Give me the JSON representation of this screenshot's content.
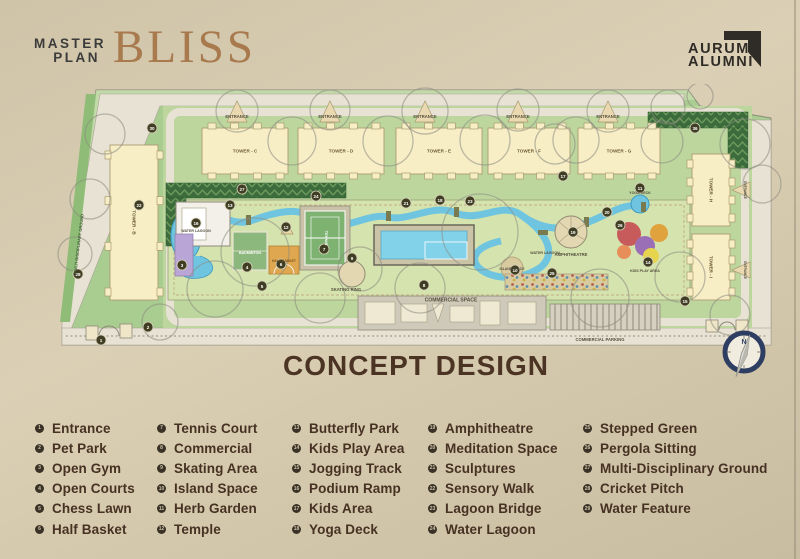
{
  "header": {
    "master": "MASTER",
    "plan": "PLAN",
    "brand": "BLISS",
    "logo_line1": "AURUM",
    "logo_line2": "ALUMNI"
  },
  "concept_title": "CONCEPT DESIGN",
  "compass": {
    "north": "N"
  },
  "plan": {
    "towers": [
      {
        "label": "TOWER - B"
      },
      {
        "label": "TOWER - C"
      },
      {
        "label": "TOWER - D"
      },
      {
        "label": "TOWER - E"
      },
      {
        "label": "TOWER - F"
      },
      {
        "label": "TOWER - G"
      },
      {
        "label": "TOWER - H"
      },
      {
        "label": "TOWER - I"
      }
    ],
    "labels": {
      "entrance": "ENTRANCE",
      "commercial_space": "COMMERCIAL SPACE",
      "commercial_parking": "COMMERCIAL PARKING",
      "skating_ring": "SKATING RING",
      "amphitheatre": "AMPHITHEATRE",
      "island_space": "ISLAND SPACE",
      "water_lagoon": "WATER LAGOON",
      "tennis": "TENNIS",
      "badminton": "BADMINTON",
      "half_basket": "HALF BASKET",
      "kids_play": "KIDS PLAY AREA",
      "yoga_deck": "YOGA DECK",
      "multi_ground": "MULTI-DISCIPLINARY GROUND"
    },
    "markers": [
      {
        "n": "1",
        "x": 101,
        "y": 256
      },
      {
        "n": "2",
        "x": 148,
        "y": 243
      },
      {
        "n": "3",
        "x": 182,
        "y": 181
      },
      {
        "n": "4",
        "x": 247,
        "y": 183
      },
      {
        "n": "5",
        "x": 262,
        "y": 202
      },
      {
        "n": "6",
        "x": 281,
        "y": 180
      },
      {
        "n": "7",
        "x": 324,
        "y": 165
      },
      {
        "n": "8",
        "x": 424,
        "y": 201
      },
      {
        "n": "9",
        "x": 352,
        "y": 174
      },
      {
        "n": "10",
        "x": 515,
        "y": 186
      },
      {
        "n": "11",
        "x": 640,
        "y": 104
      },
      {
        "n": "12",
        "x": 286,
        "y": 143
      },
      {
        "n": "13",
        "x": 230,
        "y": 121
      },
      {
        "n": "14",
        "x": 648,
        "y": 178
      },
      {
        "n": "15",
        "x": 685,
        "y": 217
      },
      {
        "n": "16",
        "x": 196,
        "y": 139
      },
      {
        "n": "17",
        "x": 563,
        "y": 92
      },
      {
        "n": "18",
        "x": 440,
        "y": 116
      },
      {
        "n": "19",
        "x": 573,
        "y": 148
      },
      {
        "n": "20",
        "x": 607,
        "y": 128
      },
      {
        "n": "21",
        "x": 406,
        "y": 119
      },
      {
        "n": "22",
        "x": 139,
        "y": 121
      },
      {
        "n": "23",
        "x": 470,
        "y": 117
      },
      {
        "n": "24",
        "x": 316,
        "y": 112
      },
      {
        "n": "25",
        "x": 552,
        "y": 189
      },
      {
        "n": "26",
        "x": 620,
        "y": 141
      },
      {
        "n": "27",
        "x": 242,
        "y": 105
      },
      {
        "n": "28",
        "x": 78,
        "y": 190
      },
      {
        "n": "30",
        "x": 152,
        "y": 44
      },
      {
        "n": "36",
        "x": 695,
        "y": 44
      }
    ],
    "colors": {
      "site_green": "#a9cc90",
      "podium_green": "#d5e3ae",
      "lagoon_blue": "#6fc5e0",
      "tower_cream": "#f7eec6",
      "court_green": "#7db271",
      "basket_orange": "#dfa750"
    }
  },
  "legend": {
    "columns": [
      [
        {
          "n": "1",
          "label": "Entrance"
        },
        {
          "n": "2",
          "label": "Pet Park"
        },
        {
          "n": "3",
          "label": "Open Gym"
        },
        {
          "n": "4",
          "label": "Open Courts"
        },
        {
          "n": "5",
          "label": "Chess Lawn"
        },
        {
          "n": "6",
          "label": "Half Basket"
        }
      ],
      [
        {
          "n": "7",
          "label": "Tennis Court"
        },
        {
          "n": "8",
          "label": "Commercial"
        },
        {
          "n": "9",
          "label": "Skating Area"
        },
        {
          "n": "10",
          "label": "Island Space"
        },
        {
          "n": "11",
          "label": "Herb Garden"
        },
        {
          "n": "12",
          "label": "Temple"
        }
      ],
      [
        {
          "n": "13",
          "label": "Butterfly Park"
        },
        {
          "n": "14",
          "label": "Kids Play Area"
        },
        {
          "n": "15",
          "label": "Jogging Track"
        },
        {
          "n": "16",
          "label": "Podium Ramp"
        },
        {
          "n": "17",
          "label": "Kids Area"
        },
        {
          "n": "18",
          "label": "Yoga Deck"
        }
      ],
      [
        {
          "n": "19",
          "label": "Amphitheatre"
        },
        {
          "n": "20",
          "label": "Meditation Space"
        },
        {
          "n": "21",
          "label": "Sculptures"
        },
        {
          "n": "22",
          "label": "Sensory Walk"
        },
        {
          "n": "23",
          "label": "Lagoon Bridge"
        },
        {
          "n": "24",
          "label": "Water Lagoon"
        }
      ],
      [
        {
          "n": "25",
          "label": "Stepped Green"
        },
        {
          "n": "26",
          "label": "Pergola Sitting"
        },
        {
          "n": "27",
          "label": "Multi-Disciplinary Ground"
        },
        {
          "n": "28",
          "label": "Cricket Pitch"
        },
        {
          "n": "29",
          "label": "Water Feature"
        }
      ]
    ]
  }
}
